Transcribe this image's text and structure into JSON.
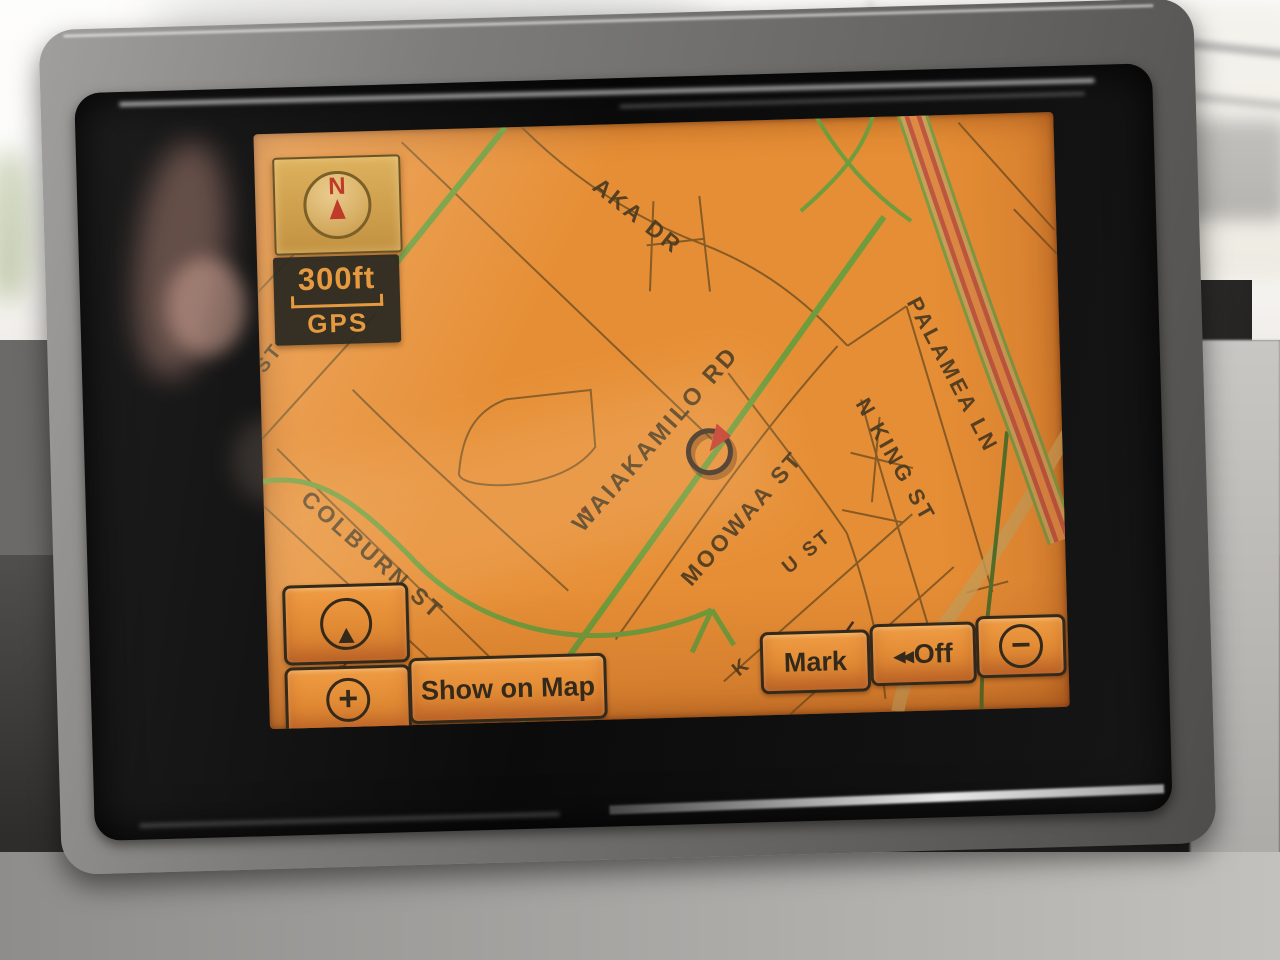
{
  "nav": {
    "compass": {
      "north_label": "N"
    },
    "scale": {
      "distance": "300ft",
      "signal": "GPS"
    },
    "streets": {
      "aka_dr": "AKA DR",
      "waiakamilo_rd": "WAIAKAMILO RD",
      "moowaa_st": "MOOWAA ST",
      "colburn_st": "COLBURN ST",
      "palamea_ln": "PALAMEA LN",
      "n_king_st": "N KING ST",
      "frag_left_st": "ST",
      "frag_u_st": "U ST",
      "frag_k": "K",
      "frag_s": "S"
    },
    "buttons": {
      "show_on_map": "Show on Map",
      "mark": "Mark",
      "off": "Off"
    },
    "icons": {
      "zoom_in_glyph": "+",
      "zoom_out_glyph": "−",
      "voice_off_chevrons": "◀◀"
    },
    "colors": {
      "map_background": "#E68E35",
      "minor_road": "#7D5624",
      "major_road_green": "#6F9C3C",
      "highway_red": "#BF5640",
      "highway_tan": "#C9A057",
      "marker_red": "#C0392B",
      "label_text": "#4A3A20",
      "button_text": "#342A1C",
      "scale_text": "#E59A3F",
      "compass_red": "#BF3A28"
    }
  }
}
